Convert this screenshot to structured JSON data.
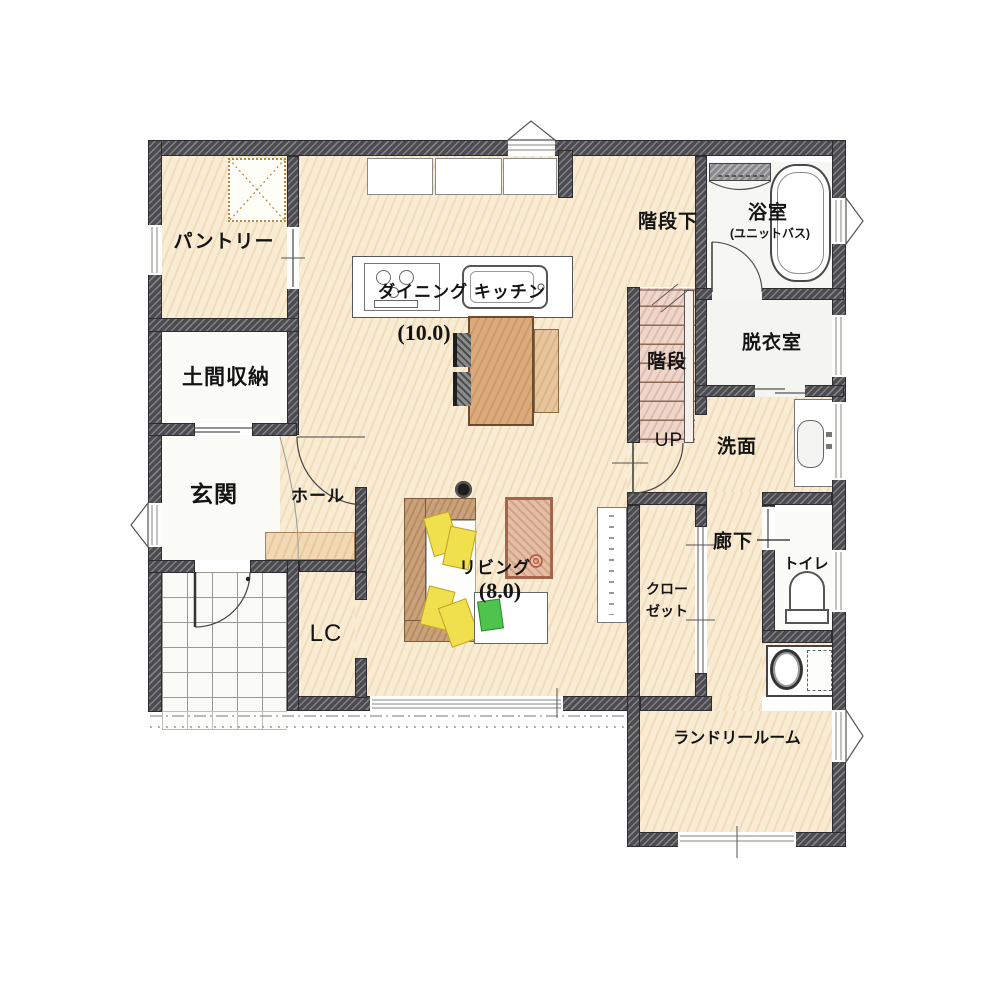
{
  "plan": {
    "rooms": {
      "pantry": {
        "label": "パントリー"
      },
      "doma_storage": {
        "label": "土間収納"
      },
      "entrance": {
        "label": "玄関"
      },
      "hall": {
        "label": "ホール"
      },
      "living_closet": {
        "label": "LC"
      },
      "dining_kitchen": {
        "label": "ダイニング キッチン",
        "size": "(10.0)"
      },
      "living": {
        "label": "リビング",
        "size": "(8.0)"
      },
      "under_stairs": {
        "label": "階段下"
      },
      "stairs": {
        "label": "階段",
        "direction_label": "UP"
      },
      "bathroom": {
        "label": "浴室",
        "sublabel": "(ユニットバス)"
      },
      "changing_room": {
        "label": "脱衣室"
      },
      "washroom": {
        "label": "洗面"
      },
      "corridor": {
        "label": "廊下"
      },
      "toilet": {
        "label": "トイレ"
      },
      "closet": {
        "label_line1": "クロー",
        "label_line2": "ゼット"
      },
      "laundry_room": {
        "label": "ランドリールーム"
      }
    },
    "colors": {
      "wall": "#4b4b50",
      "floor_wood": "#f9ecd5",
      "stairs": "#eed6cb",
      "sofa_cushion": "#f1e04d",
      "accent_green": "#4ec44e",
      "wood_furniture": "#dcab7c",
      "rug": "#d5a488"
    }
  }
}
